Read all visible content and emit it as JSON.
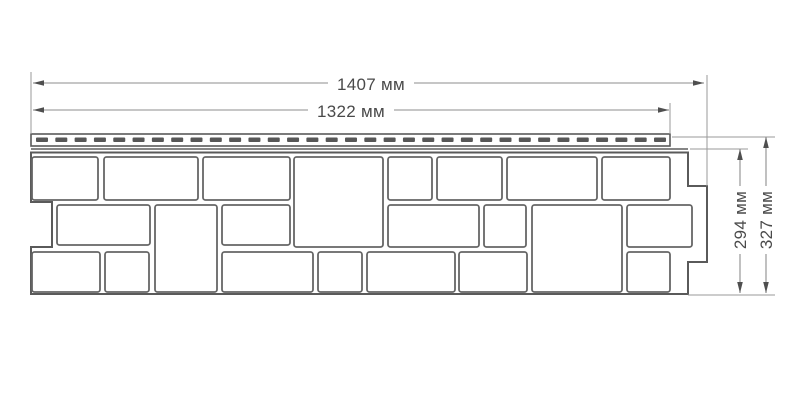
{
  "diagram": {
    "background": "#ffffff",
    "panel_line_color": "#5a5a5a",
    "stone_line_color": "#666666",
    "dim_line_color": "#8e8e8e",
    "arrow_color": "#4f4f4f",
    "text_color": "#4a4a4a",
    "dimensions": [
      {
        "id": "overall-width",
        "label": "1407 мм",
        "value": 1407,
        "unit": "мм",
        "orientation": "horizontal",
        "line": [
          33,
          83,
          704,
          83
        ],
        "arrows": [
          [
            33,
            83,
            "left"
          ],
          [
            704,
            83,
            "right"
          ]
        ],
        "label_pos": [
          371,
          84
        ],
        "rotate": 0
      },
      {
        "id": "useful-width",
        "label": "1322 мм",
        "value": 1322,
        "unit": "мм",
        "orientation": "horizontal",
        "line": [
          33,
          110,
          669,
          110
        ],
        "arrows": [
          [
            33,
            110,
            "left"
          ],
          [
            669,
            110,
            "right"
          ]
        ],
        "label_pos": [
          351,
          111
        ],
        "rotate": 0
      },
      {
        "id": "useful-height",
        "label": "294 мм",
        "value": 294,
        "unit": "мм",
        "orientation": "vertical",
        "line": [
          740,
          149,
          740,
          293
        ],
        "arrows": [
          [
            740,
            149,
            "up"
          ],
          [
            740,
            293,
            "down"
          ]
        ],
        "label_pos": [
          740,
          220
        ],
        "rotate": -90
      },
      {
        "id": "overall-height",
        "label": "327 мм",
        "value": 327,
        "unit": "мм",
        "orientation": "vertical",
        "line": [
          766,
          137,
          766,
          293
        ],
        "arrows": [
          [
            766,
            137,
            "up"
          ],
          [
            766,
            293,
            "down"
          ]
        ],
        "label_pos": [
          766,
          220
        ],
        "rotate": -90
      }
    ],
    "extension_lines": [
      [
        31,
        72,
        31,
        134
      ],
      [
        707,
        75,
        707,
        186
      ],
      [
        670,
        103,
        670,
        134
      ],
      [
        690,
        149,
        748,
        149
      ],
      [
        672,
        137,
        775,
        137
      ],
      [
        688,
        295,
        775,
        295
      ]
    ],
    "panel": {
      "outline_path": "M 31 152.5 L 688 152.5 L 688 186 L 707 186 L 707 262 L 688 262 L 688 294 L 31 294 L 31 247 L 52 247 L 52 202 L 31 202 Z",
      "lock_line": [
        31,
        149,
        688,
        149
      ],
      "nail_strip": {
        "x": 31,
        "y": 134,
        "width": 639,
        "height": 12,
        "slot": {
          "y": 137.5,
          "height": 4.5,
          "width": 12,
          "count": 33,
          "x_start": 36,
          "x_end": 666
        }
      },
      "stones": [
        [
          32,
          157,
          66,
          43
        ],
        [
          104,
          157,
          94,
          43
        ],
        [
          203,
          157,
          87,
          43
        ],
        [
          294,
          157,
          89,
          90
        ],
        [
          388,
          157,
          44,
          43
        ],
        [
          437,
          157,
          65,
          43
        ],
        [
          507,
          157,
          90,
          43
        ],
        [
          602,
          157,
          68,
          43
        ],
        [
          57,
          205,
          93,
          40
        ],
        [
          155,
          205,
          62,
          87
        ],
        [
          222,
          205,
          68,
          40
        ],
        [
          388,
          205,
          91,
          42
        ],
        [
          484,
          205,
          42,
          42
        ],
        [
          532,
          205,
          90,
          87
        ],
        [
          627,
          205,
          65,
          42
        ],
        [
          32,
          252,
          68,
          40
        ],
        [
          105,
          252,
          44,
          40
        ],
        [
          222,
          252,
          91,
          40
        ],
        [
          318,
          252,
          44,
          40
        ],
        [
          367,
          252,
          88,
          40
        ],
        [
          459,
          252,
          68,
          40
        ],
        [
          627,
          252,
          43,
          40
        ]
      ]
    }
  }
}
